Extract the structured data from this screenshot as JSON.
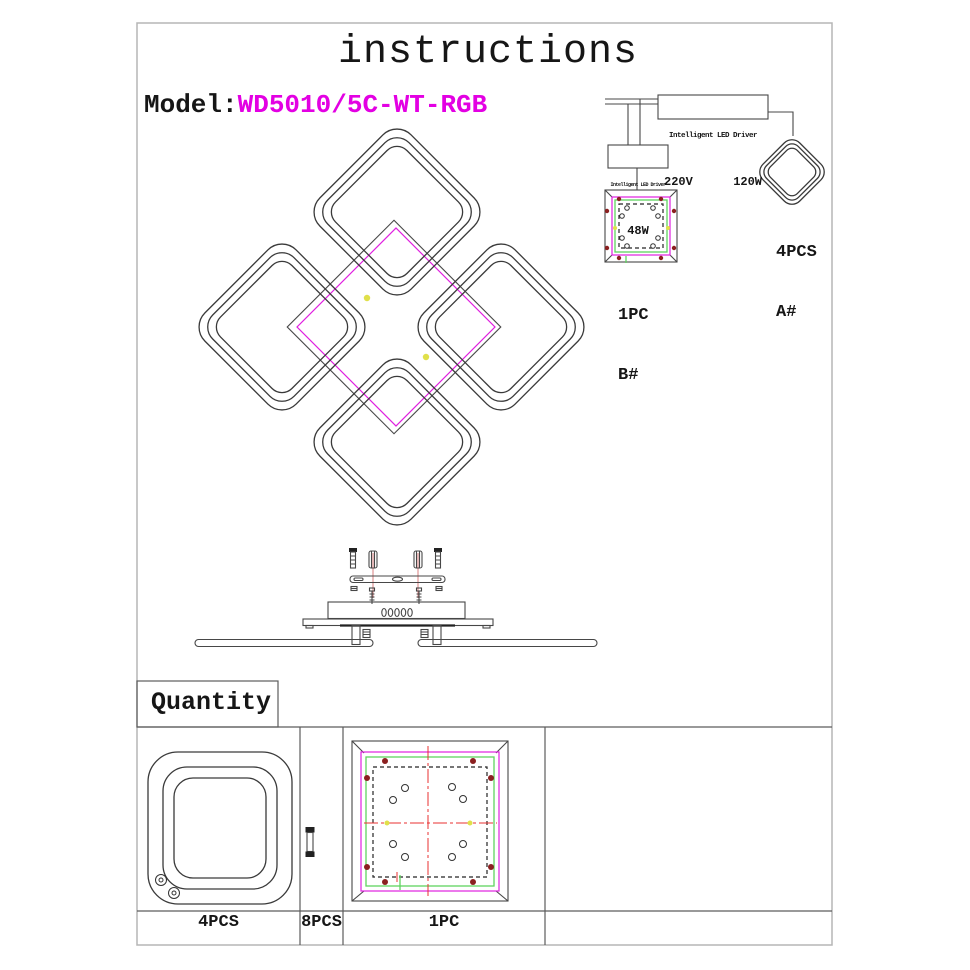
{
  "header": {
    "title": "instructions",
    "model_label": "Model:",
    "model_value": "WD5010/5C-WT-RGB"
  },
  "wiring_diagram": {
    "main_driver": {
      "name": "Intelligent LED Driver",
      "voltage": "220V",
      "power": "120W"
    },
    "sub_driver": {
      "name": "Intelligent LED Driver",
      "power": "48W"
    },
    "ring_part": {
      "qty": "4PCS",
      "code": "A#"
    },
    "base_part": {
      "qty": "1PC",
      "code": "B#"
    }
  },
  "quantity_section": {
    "label": "Quantity",
    "items": [
      {
        "name": "square ring frame",
        "qty": "4PCS"
      },
      {
        "name": "standoff screw",
        "qty": "8PCS"
      },
      {
        "name": "base plate",
        "qty": "1PC"
      }
    ]
  },
  "colors": {
    "model_text": "#e300e3",
    "magenta_line": "#e020e0",
    "green_line": "#5fd45f",
    "screw_dot_red": "#8b2020",
    "marker_yellow": "#e0e04a",
    "crosshair_red": "#e83030",
    "line_art": "#3a3a3a"
  }
}
